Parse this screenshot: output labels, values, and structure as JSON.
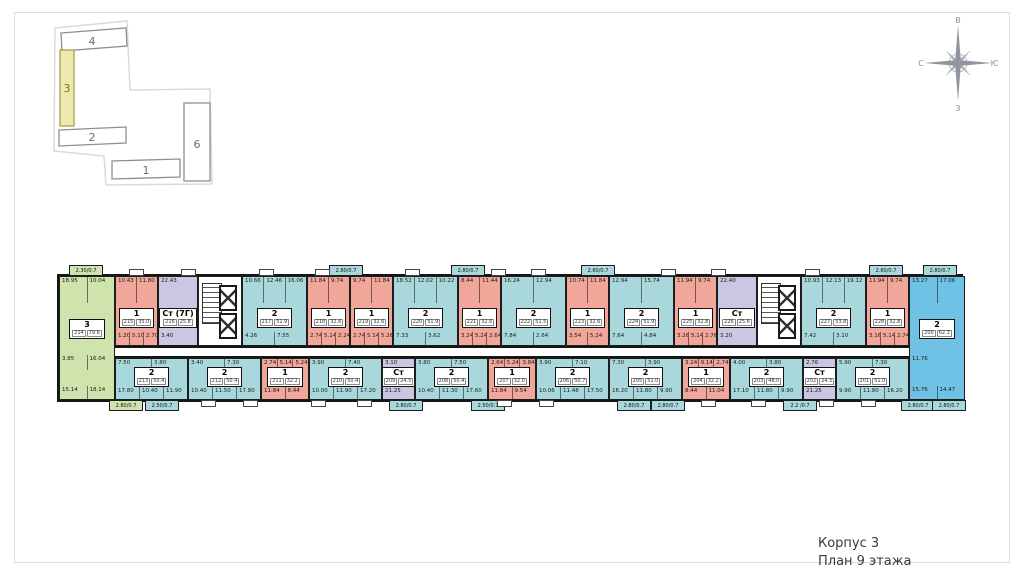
{
  "caption": {
    "line1": "Корпус 3",
    "line2": "План 9 этажа"
  },
  "compass": {
    "top": "В",
    "right": "Ю",
    "bottom": "З",
    "left": "С"
  },
  "site_plan": {
    "highlighted": "3",
    "buildings": [
      {
        "label": "4"
      },
      {
        "label": "3"
      },
      {
        "label": "2"
      },
      {
        "label": "1"
      },
      {
        "label": "6"
      }
    ]
  },
  "colors": {
    "room1": "#f0a79a",
    "room2": "#a9d8dc",
    "room3": "#cfe3ac",
    "studio": "#cac7e3",
    "corner2": "#6fc2e6",
    "highlight_building": "#efe9ad"
  },
  "floor_plan": {
    "green": {
      "t": "3",
      "n": "214",
      "a": "79.6",
      "c": "green",
      "top": [
        "18.95",
        "10.04"
      ],
      "mid": [
        "3.85",
        "16.04"
      ],
      "bot": [
        "15.14",
        "18.14"
      ]
    },
    "corner": {
      "t": "2",
      "n": "200",
      "a": "62.3",
      "c": "bright",
      "top": [
        "13.27",
        "17.06"
      ],
      "mid": [
        "11.76"
      ],
      "bot": [
        "15.76",
        "14.47"
      ]
    },
    "top_row": [
      {
        "t": "1",
        "n": "215",
        "a": "35.0",
        "c": "salmon",
        "w": 43,
        "top": [
          "10.43",
          "11.80"
        ],
        "bot": [
          "1.20",
          "5.10",
          "2.70"
        ]
      },
      {
        "t": "Ст (7Г)",
        "n": "216",
        "a": "25.8",
        "c": "purple",
        "w": 40,
        "top": [
          "22.43"
        ],
        "bot": [
          "3.40"
        ]
      },
      {
        "t": "core",
        "w": 44
      },
      {
        "t": "2",
        "n": "217",
        "a": "51.9",
        "c": "blue",
        "w": 65,
        "top": [
          "10.66",
          "12.46",
          "16.06"
        ],
        "bot": [
          "4.26",
          "7.55"
        ]
      },
      {
        "t": "1",
        "n": "218",
        "a": "32.6",
        "c": "salmon",
        "w": 43,
        "top": [
          "11.84",
          "9.74"
        ],
        "bot": [
          "2.74",
          "5.14",
          "2.24"
        ]
      },
      {
        "t": "1",
        "n": "219",
        "a": "32.6",
        "c": "salmon",
        "w": 43,
        "top": [
          "9.74",
          "11.84"
        ],
        "bot": [
          "2.74",
          "5.14",
          "5.26"
        ]
      },
      {
        "t": "2",
        "n": "220",
        "a": "51.9",
        "c": "blue",
        "w": 65,
        "top": [
          "18.52",
          "12.02",
          "10.22"
        ],
        "bot": [
          "7.33",
          "3.62"
        ]
      },
      {
        "t": "1",
        "n": "221",
        "a": "32.6",
        "c": "salmon",
        "w": 43,
        "top": [
          "8.44",
          "11.44"
        ],
        "bot": [
          "3.24",
          "5.24",
          "2.64"
        ]
      },
      {
        "t": "2",
        "n": "222",
        "a": "51.5",
        "c": "blue",
        "w": 65,
        "top": [
          "16.24",
          "12.94"
        ],
        "bot": [
          "7.84",
          "2.64"
        ]
      },
      {
        "t": "1",
        "n": "223",
        "a": "32.6",
        "c": "salmon",
        "w": 43,
        "top": [
          "10.74",
          "11.84"
        ],
        "bot": [
          "3.54",
          "5.24"
        ]
      },
      {
        "t": "2",
        "n": "224",
        "a": "51.9",
        "c": "blue",
        "w": 65,
        "top": [
          "12.94",
          "15.74"
        ],
        "bot": [
          "7.64",
          "4.84"
        ]
      },
      {
        "t": "1",
        "n": "225",
        "a": "32.8",
        "c": "salmon",
        "w": 43,
        "top": [
          "11.94",
          "9.74"
        ],
        "bot": [
          "3.26",
          "5.14",
          "2.76"
        ]
      },
      {
        "t": "Ст",
        "n": "226",
        "a": "25.6",
        "c": "purple",
        "w": 40,
        "top": [
          "22.40"
        ],
        "bot": [
          "3.20"
        ]
      },
      {
        "t": "core",
        "w": 44
      },
      {
        "t": "2",
        "n": "227",
        "a": "53.8",
        "c": "blue",
        "w": 65,
        "top": [
          "10.93",
          "12.13",
          "19.12"
        ],
        "bot": [
          "7.42",
          "3.10"
        ]
      },
      {
        "t": "1",
        "n": "228",
        "a": "32.8",
        "c": "salmon",
        "w": 43,
        "top": [
          "11.94",
          "9.74"
        ],
        "bot": [
          "3.16",
          "5.14",
          "2.74"
        ]
      }
    ],
    "bottom_row": [
      {
        "t": "2",
        "n": "213",
        "a": "50.4",
        "c": "blue",
        "w": 73,
        "top": [
          "7.50",
          "3.80"
        ],
        "bot": [
          "17.80",
          "10.40",
          "11.90"
        ]
      },
      {
        "t": "2",
        "n": "212",
        "a": "50.4",
        "c": "blue",
        "w": 73,
        "top": [
          "3.40",
          "7.30"
        ],
        "bot": [
          "10.40",
          "11.50",
          "17.80"
        ]
      },
      {
        "t": "1",
        "n": "211",
        "a": "32.2",
        "c": "salmon",
        "w": 48,
        "top": [
          "2.74",
          "5.14",
          "5.24"
        ],
        "bot": [
          "11.84",
          "8.44"
        ]
      },
      {
        "t": "2",
        "n": "210",
        "a": "50.4",
        "c": "blue",
        "w": 73,
        "top": [
          "3.90",
          "7.40"
        ],
        "bot": [
          "10.00",
          "11.90",
          "17.20"
        ]
      },
      {
        "t": "Ст",
        "n": "209",
        "a": "24.5",
        "c": "purple",
        "w": 33,
        "top": [
          "3.10"
        ],
        "bot": [
          "21.25"
        ]
      },
      {
        "t": "2",
        "n": "208",
        "a": "50.4",
        "c": "blue",
        "w": 73,
        "top": [
          "3.80",
          "7.50"
        ],
        "bot": [
          "10.40",
          "11.30",
          "17.60"
        ]
      },
      {
        "t": "1",
        "n": "207",
        "a": "32.0",
        "c": "salmon",
        "w": 48,
        "top": [
          "2.64",
          "5.24",
          "3.84"
        ],
        "bot": [
          "11.84",
          "9.54"
        ]
      },
      {
        "t": "2",
        "n": "206",
        "a": "50.7",
        "c": "blue",
        "w": 73,
        "top": [
          "3.90",
          "7.10"
        ],
        "bot": [
          "10.06",
          "11.48",
          "17.50"
        ]
      },
      {
        "t": "2",
        "n": "205",
        "a": "51.0",
        "c": "blue",
        "w": 73,
        "top": [
          "7.30",
          "3.90"
        ],
        "bot": [
          "16.20",
          "11.80",
          "9.90"
        ]
      },
      {
        "t": "1",
        "n": "204",
        "a": "32.2",
        "c": "salmon",
        "w": 48,
        "top": [
          "3.24",
          "9.14",
          "2.74"
        ],
        "bot": [
          "8.44",
          "11.04"
        ]
      },
      {
        "t": "2",
        "n": "203",
        "a": "48.0",
        "c": "blue",
        "w": 73,
        "top": [
          "4.00",
          "3.80"
        ],
        "bot": [
          "17.10",
          "11.80",
          "9.90"
        ]
      },
      {
        "t": "Ст",
        "n": "202",
        "a": "24.5",
        "c": "purple",
        "w": 33,
        "top": [
          "2.76"
        ],
        "bot": [
          "21.25"
        ]
      },
      {
        "t": "2",
        "n": "201",
        "a": "51.0",
        "c": "blue",
        "w": 73,
        "top": [
          "5.90",
          "7.30"
        ],
        "bot": [
          "9.90",
          "11.80",
          "16.20"
        ]
      }
    ],
    "balconies_top": [
      {
        "l": "2.30/0.7",
        "x": 10,
        "c": "green"
      },
      {
        "l": "2.80/0.7",
        "x": 270,
        "c": "blue"
      },
      {
        "l": "2.80/0.7",
        "x": 392,
        "c": "blue"
      },
      {
        "l": "2.80/0.7",
        "x": 522,
        "c": "blue"
      },
      {
        "l": "2.80/0.7",
        "x": 810,
        "c": "blue"
      },
      {
        "l": "2.80/0.7",
        "x": 864,
        "c": "blue"
      }
    ],
    "balconies_bottom": [
      {
        "l": "2.80/0.7",
        "x": 50,
        "c": "green"
      },
      {
        "l": "2.50/0.7",
        "x": 86,
        "c": "blue"
      },
      {
        "l": "2.80/0.7",
        "x": 330,
        "c": "blue"
      },
      {
        "l": "2.50/0.7",
        "x": 412,
        "c": "blue"
      },
      {
        "l": "2.80/0.7",
        "x": 558,
        "c": "blue"
      },
      {
        "l": "2.80/0.7",
        "x": 592,
        "c": "blue"
      },
      {
        "l": "2.2 /0.7",
        "x": 724,
        "c": "blue"
      },
      {
        "l": "2.80/0.7",
        "x": 842,
        "c": "blue"
      },
      {
        "l": "2.80/0.7",
        "x": 873,
        "c": "blue"
      }
    ],
    "porches_top": [
      70,
      122,
      200,
      256,
      346,
      432,
      472,
      602,
      652,
      746
    ],
    "porches_bottom": [
      142,
      184,
      252,
      298,
      438,
      480,
      642,
      692,
      760,
      802
    ]
  }
}
